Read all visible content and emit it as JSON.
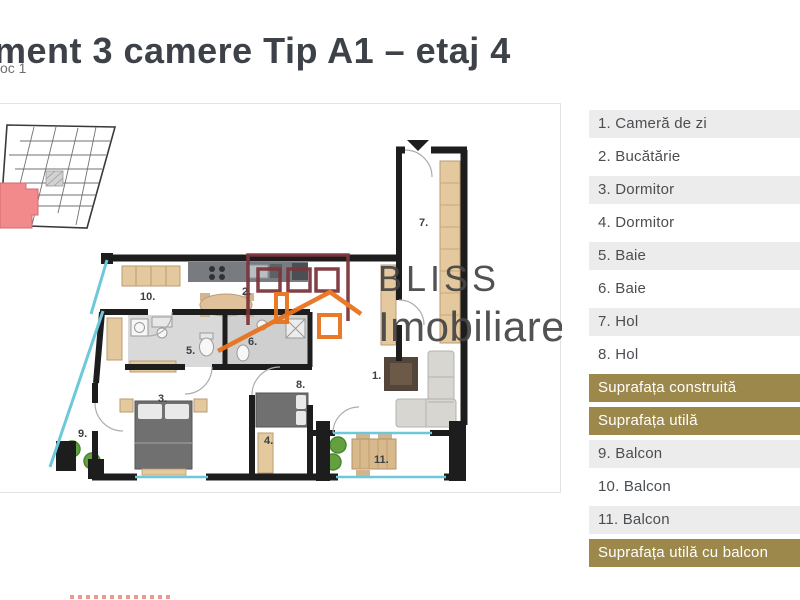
{
  "header": {
    "title": "ment 3 camere Tip A1 – etaj 4",
    "subtitle": "oc 1"
  },
  "watermark": {
    "brand_line1": "BLISS",
    "brand_line2": "Imobiliare"
  },
  "plan": {
    "room_labels": [
      {
        "text": "1.",
        "x": 372,
        "y": 272
      },
      {
        "text": "2.",
        "x": 242,
        "y": 188
      },
      {
        "text": "3.",
        "x": 158,
        "y": 295
      },
      {
        "text": "4.",
        "x": 264,
        "y": 337
      },
      {
        "text": "5.",
        "x": 186,
        "y": 247
      },
      {
        "text": "6.",
        "x": 248,
        "y": 238
      },
      {
        "text": "7.",
        "x": 419,
        "y": 119
      },
      {
        "text": "8.",
        "x": 296,
        "y": 281
      },
      {
        "text": "9.",
        "x": 78,
        "y": 330
      },
      {
        "text": "10.",
        "x": 140,
        "y": 193
      },
      {
        "text": "11.",
        "x": 374,
        "y": 356
      }
    ]
  },
  "legend": {
    "rows": [
      {
        "label": "1. Cameră de zi",
        "variant": "gray"
      },
      {
        "label": "2. Bucătărie",
        "variant": "white"
      },
      {
        "label": "3. Dormitor",
        "variant": "gray"
      },
      {
        "label": "4. Dormitor",
        "variant": "white"
      },
      {
        "label": "5. Baie",
        "variant": "gray"
      },
      {
        "label": "6. Baie",
        "variant": "white"
      },
      {
        "label": "7. Hol",
        "variant": "gray"
      },
      {
        "label": "8. Hol",
        "variant": "white"
      },
      {
        "label": "Suprafața construită",
        "variant": "gold"
      },
      {
        "label": "Suprafața utilă",
        "variant": "gold"
      },
      {
        "label": "9. Balcon",
        "variant": "gray"
      },
      {
        "label": "10. Balcon",
        "variant": "white"
      },
      {
        "label": "11. Balcon",
        "variant": "gray"
      },
      {
        "label": "Suprafața utilă cu balcon",
        "variant": "gold"
      }
    ]
  },
  "colors": {
    "accent_gold": "#9d884c",
    "logo_maroon": "#7d353d",
    "logo_orange": "#e8731e",
    "site_highlight_red": "#f28a8c",
    "window_cyan": "#6cc8da"
  }
}
